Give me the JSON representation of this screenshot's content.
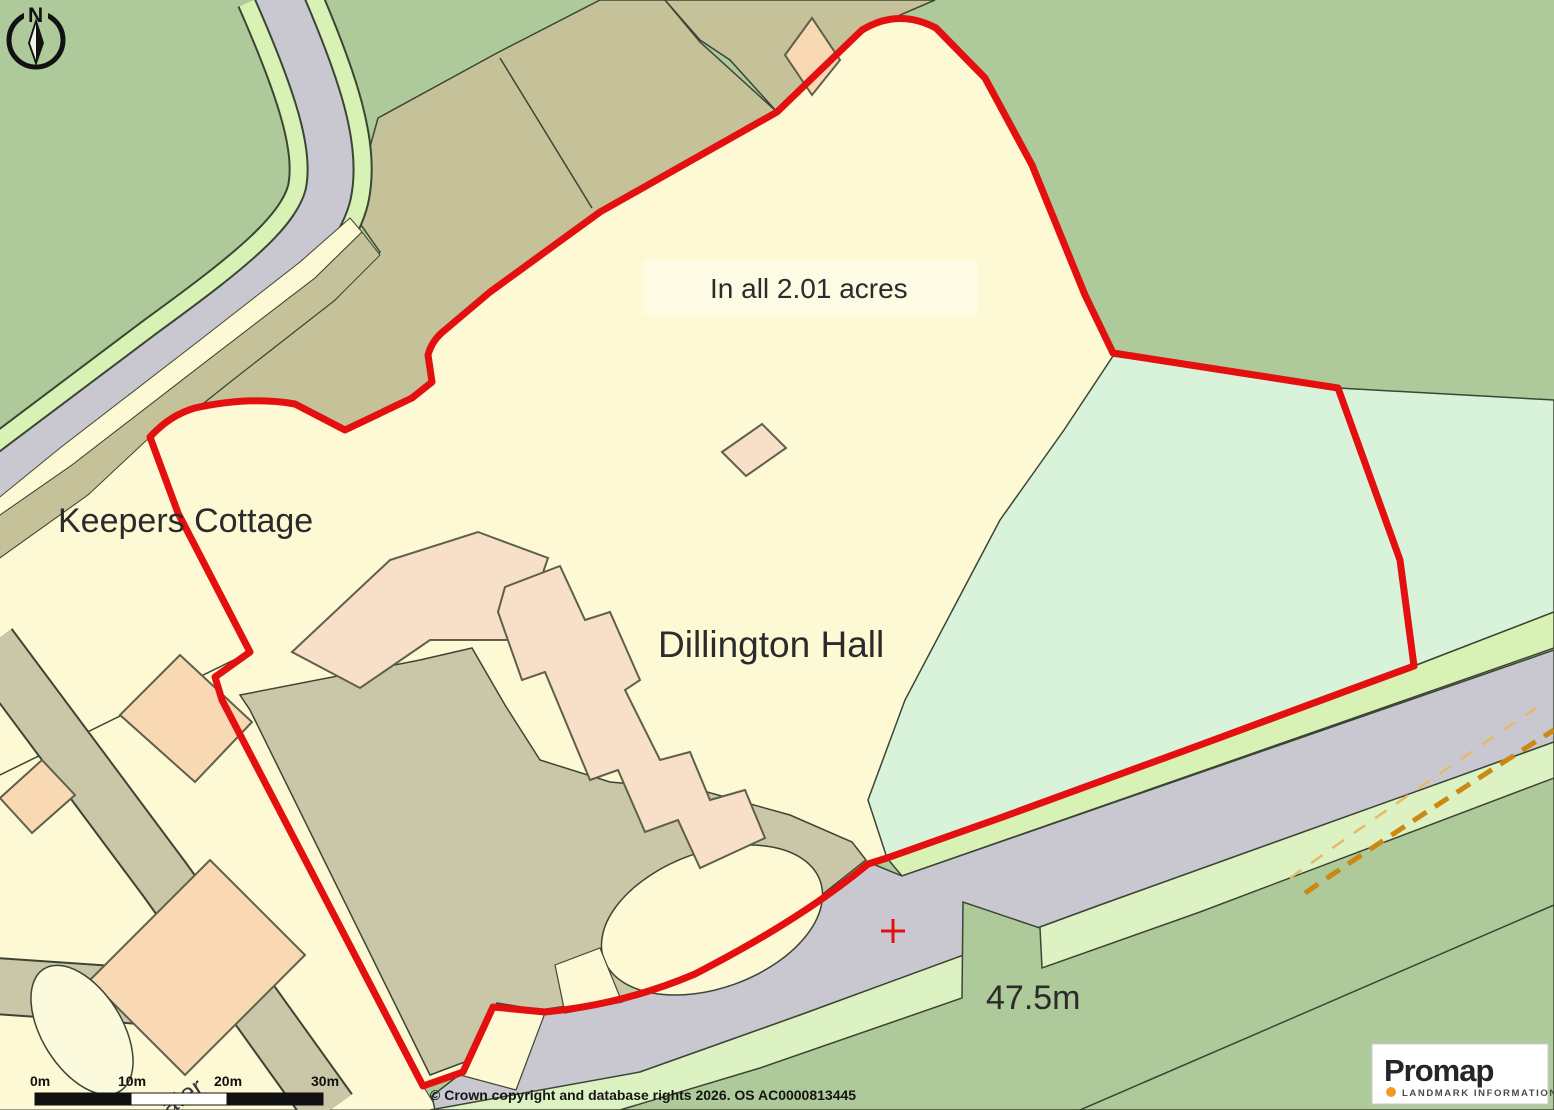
{
  "map": {
    "labels": {
      "keepers_cottage": "Keepers Cottage",
      "area_statement": "In all 2.01 acres",
      "hall_name": "Dillington Hall",
      "spot_height": "47.5m",
      "street_partial": "ater"
    },
    "compass": {
      "letter": "N"
    },
    "scalebar": {
      "ticks": [
        "0m",
        "10m",
        "20m",
        "30m"
      ]
    },
    "copyright": "© Crown copyright and database rights 2026. OS AC0000813445",
    "logo": {
      "name": "Promap",
      "tagline": "LANDMARK INFORMATION"
    },
    "colors": {
      "boundary_red": "#e40f0f",
      "field_sage": "#aeca9b",
      "pasture_mint": "#d9f2da",
      "verge_green": "#d8f2b6",
      "road_grey": "#c9c8d1",
      "parcel_khaki": "#c5c29a",
      "yard_olive": "#c9c7a8",
      "parcel_cream": "#fcf9d4",
      "building_peach": "#f8d9b4",
      "hall_peach": "#f8dfc8",
      "track_orange": "#cc8811",
      "outline_dark": "#3c4534"
    }
  }
}
